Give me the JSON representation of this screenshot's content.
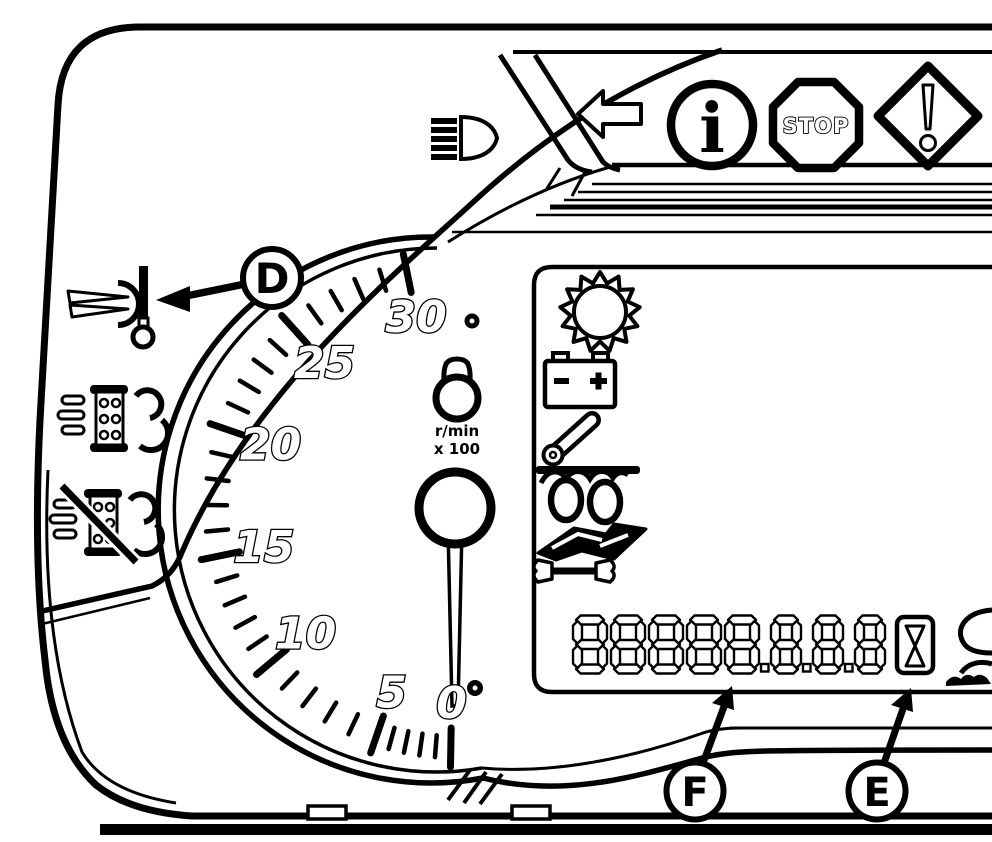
{
  "colors": {
    "ink": "#000000",
    "paper": "#ffffff"
  },
  "callouts": {
    "d": "D",
    "e": "E",
    "f": "F"
  },
  "top_strip": {
    "icons": [
      "headlight-icon",
      "left-arrow-icon",
      "info-icon",
      "stop-icon",
      "warning-diamond-icon"
    ],
    "info_glyph": "i",
    "stop_label": "STOP"
  },
  "left_column_icons": [
    "coolant-temperature-icon",
    "pto-engaged-icon",
    "pto-disengaged-icon"
  ],
  "tachometer": {
    "unit_line1": "r/min",
    "unit_line2": "x 100",
    "min": 0,
    "max": 30,
    "minor_step": 1,
    "major_step": 5,
    "major_labels": [
      "0",
      "5",
      "10",
      "15",
      "20",
      "25",
      "30"
    ],
    "needle_value": 0
  },
  "lcd_panel": {
    "icons": [
      "gear-icon",
      "battery-icon",
      "hitch-cylinder-icon",
      "coupling-loops-icon",
      "operator-manual-icon",
      "wrench-icon"
    ],
    "status_icons": [
      "hourglass-icon",
      "implement-icon-partial"
    ],
    "display": {
      "digit_glyph": "8",
      "digit_count": 8,
      "decimal_points_after_digits": [
        5,
        6,
        7
      ]
    }
  }
}
